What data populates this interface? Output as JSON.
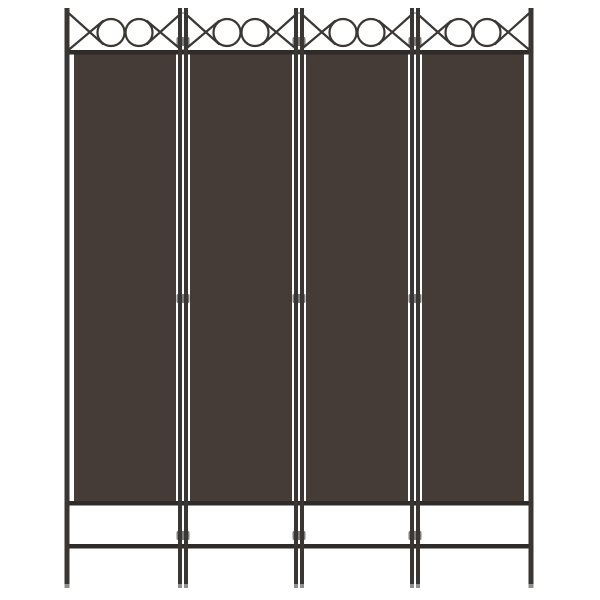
{
  "scene": {
    "type": "product-image",
    "subject": "4-panel folding room divider privacy screen, brown fabric with black steel frame",
    "background_color": "#ffffff",
    "panel_count": 4,
    "colors": {
      "fabric": "#453b37",
      "frame": "#393633",
      "rail": "#2e2b29",
      "ornament_stroke": "#3a3734",
      "hinge": "#7d7d7d",
      "leg_tip": "#8f8f8f",
      "background": "#ffffff"
    },
    "decoration": {
      "motif": "crossed-diagonals-and-double-rings",
      "rings_per_panel": 2,
      "hinges_per_joint": 3
    },
    "geometry": {
      "canvas_w": 600,
      "canvas_h": 600,
      "joint_centers_x": [
        67,
        183,
        299,
        415,
        531
      ],
      "post_top_y": 8,
      "leg_bottom_y": 588,
      "outer_post_w": 5,
      "joint_post_w": 4,
      "joint_post_gap": 2,
      "top_bar_y": 50,
      "bar_h": 4.5,
      "fabric_top_y": 54,
      "fabric_bottom_y": 502,
      "fabric_side_inset": 7,
      "bottom_bar_y": 501,
      "foot_bar_y": 544,
      "hinge_ys": [
        37,
        294,
        531
      ],
      "hinge_w": 13,
      "hinge_h": 9,
      "ring_cy": 32.5,
      "ring_r": 13.5,
      "ring_offset": 14,
      "stroke_w": 2.2,
      "diag_top_y": 13,
      "diag_bottom_y": 50,
      "diag_end_dx": 22,
      "diag_touch_upper_y": 21,
      "diag_touch_lower_y": 44,
      "leg_tip_h": 4
    }
  }
}
